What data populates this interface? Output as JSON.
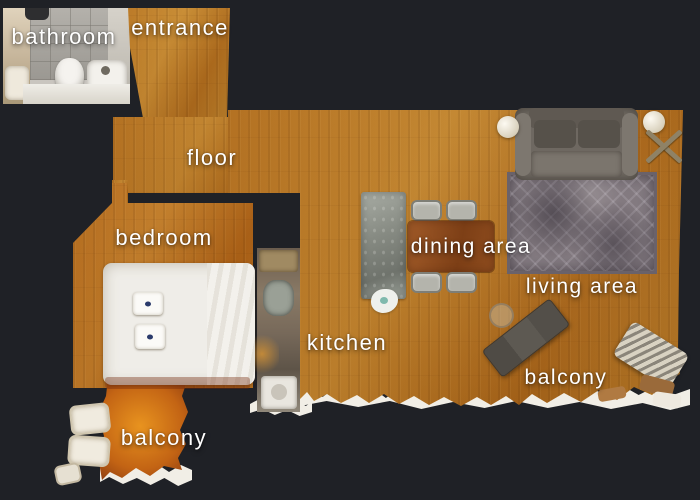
{
  "scene": {
    "type": "apartment-floor-plan-top-view"
  },
  "labels": {
    "bathroom": "bathroom",
    "entrance": "entrance",
    "floor": "floor",
    "bedroom": "bedroom",
    "kitchen": "kitchen",
    "dining_area": "dining area",
    "living_area": "living area",
    "balcony_left": "balcony",
    "balcony_right": "balcony"
  },
  "colors": {
    "background": "#1f2126",
    "wood_floor": "#b5731f",
    "balcony_wood": "#d07a16",
    "scan_edge_white": "#f1eee6",
    "label_text": "#ffffff",
    "rug": "#837a80",
    "sofa": "#6e6861",
    "dining_table": "#8e4c1e",
    "kitchen_island": "#878b83"
  },
  "furniture_icons": [
    "toilet-icon",
    "sink-icon",
    "bed-icon",
    "pillow-icon",
    "kitchen-island-icon",
    "dining-table-icon",
    "dining-chair-icon",
    "sofa-icon",
    "rug-icon",
    "floor-lamp-icon",
    "x-side-table-icon",
    "lounge-chair-icon",
    "outdoor-chair-icon",
    "washing-machine-icon",
    "glass-table-icon"
  ]
}
